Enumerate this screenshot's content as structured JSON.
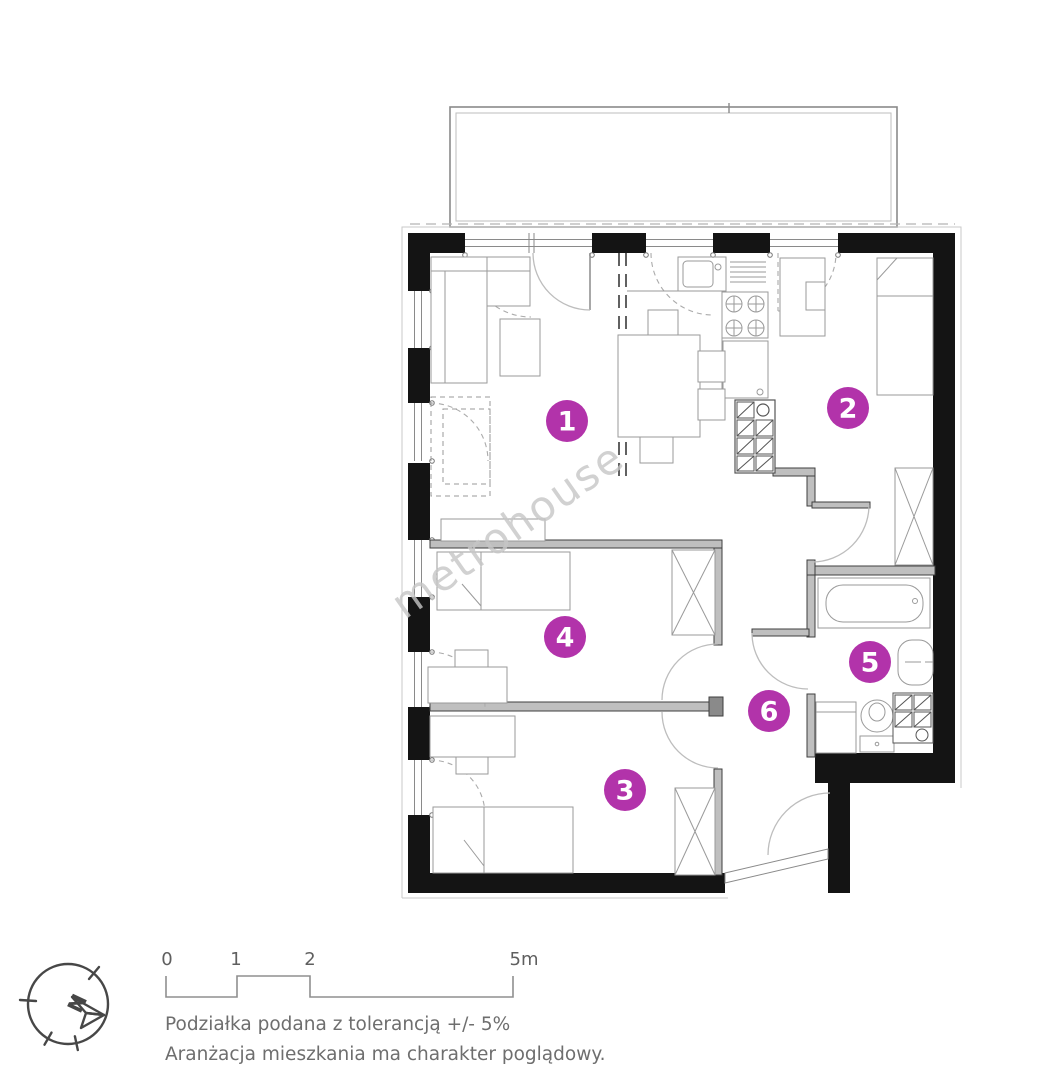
{
  "plan": {
    "watermark": "metrohouse",
    "rooms": [
      {
        "label": "1"
      },
      {
        "label": "2"
      },
      {
        "label": "3"
      },
      {
        "label": "4"
      },
      {
        "label": "5"
      },
      {
        "label": "6"
      }
    ]
  },
  "compass": {
    "north_label": "N"
  },
  "scale_bar": {
    "ticks": [
      "0",
      "1",
      "2",
      "5m"
    ]
  },
  "notes": {
    "line1": "Podziałka podana z tolerancją +/- 5%",
    "line2": "Aranżacja mieszkania ma charakter poglądowy."
  },
  "colors": {
    "accent": "#b233aa",
    "wall": "#141414",
    "thin_wall": "#bfbfbf",
    "furniture": "#9a9a9a",
    "arc": "#bdbdbd",
    "text": "#6e6e6e"
  }
}
